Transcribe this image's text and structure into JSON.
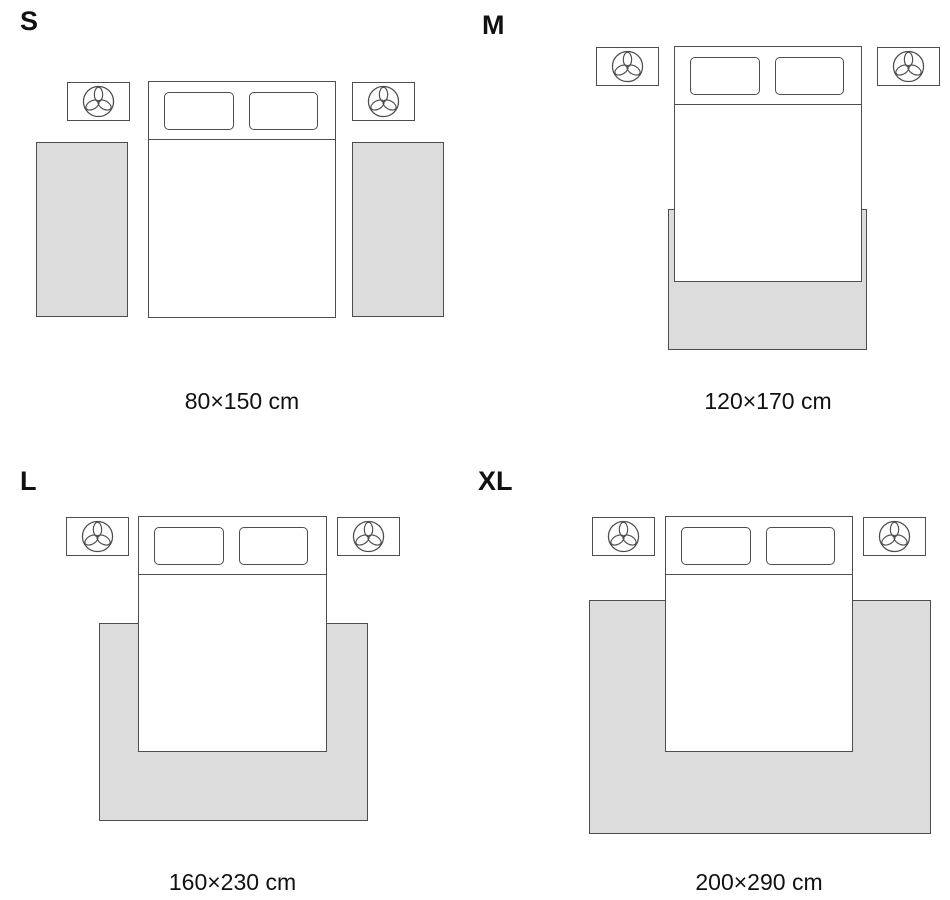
{
  "colors": {
    "background": "#ffffff",
    "outline": "#4d4d4d",
    "rug_fill": "#dcdcdc",
    "text": "#111111"
  },
  "icons": {
    "nightstand_icon": "plant-icon"
  },
  "panels": [
    {
      "label": "S",
      "dimensions": "80×150 cm",
      "rug_arrangement": "two runner rugs, one on each side of the bed"
    },
    {
      "label": "M",
      "dimensions": "120×170 cm",
      "rug_arrangement": "one rug under the lower third of the bed, extending past the foot"
    },
    {
      "label": "L",
      "dimensions": "160×230 cm",
      "rug_arrangement": "one wide rug under the lower two thirds of the bed, extending past both sides and the foot"
    },
    {
      "label": "XL",
      "dimensions": "200×290 cm",
      "rug_arrangement": "one extra-wide rug under most of the bed, reaching near the nightstands and past the foot"
    }
  ]
}
